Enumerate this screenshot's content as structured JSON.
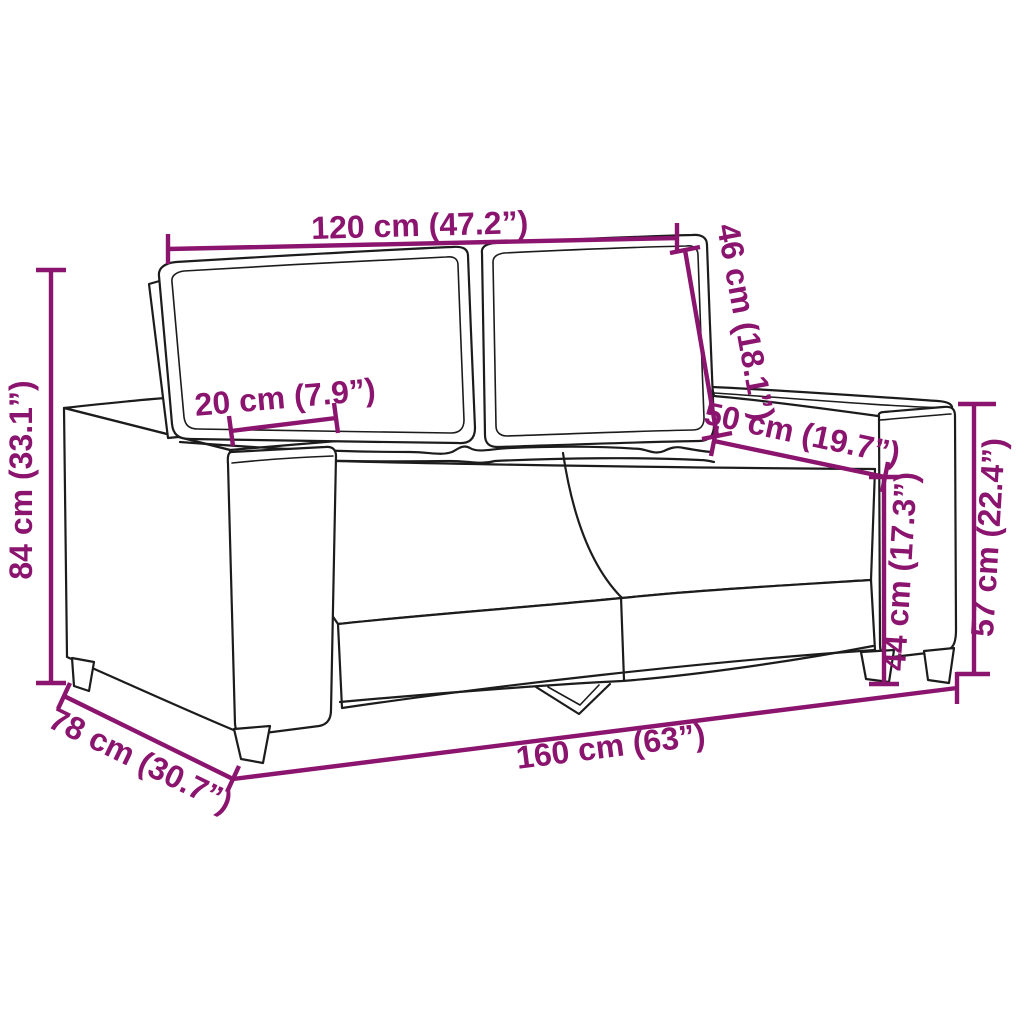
{
  "diagram": {
    "subject": "sofa-outline-line-drawing",
    "background_color": "#ffffff",
    "outline_color": "#1c1c1c",
    "dimension_color": "#8a146e",
    "labels": {
      "back_width": "120 cm (47.2”)",
      "backrest_height": "46 cm (18.1”)",
      "armrest_width": "20 cm (7.9”)",
      "seat_depth": "50 cm (19.7”)",
      "overall_height": "84 cm (33.1”)",
      "seat_height": "44 cm (17.3”)",
      "armrest_height": "57 cm (22.4”)",
      "overall_depth": "78 cm (30.7”)",
      "overall_width": "160 cm (63”)"
    }
  }
}
